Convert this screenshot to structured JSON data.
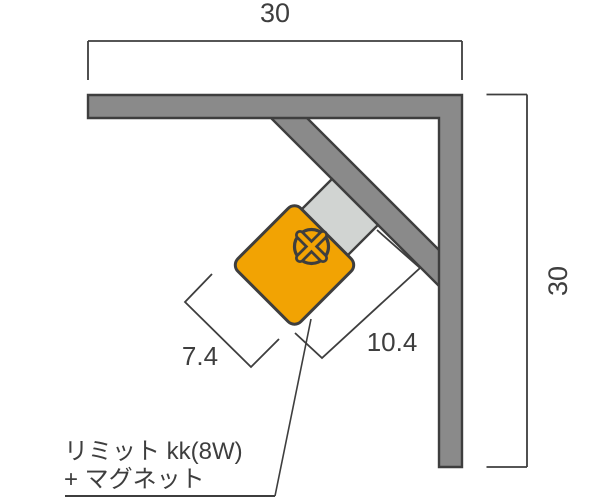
{
  "dimensions": {
    "top_width": "30",
    "right_height": "30",
    "switch_width": "7.4",
    "switch_length": "10.4"
  },
  "label": {
    "line1": "リミット kk(8W)",
    "line2": "+ マグネット"
  },
  "icons": {
    "screw_head": "circle-x-icon"
  },
  "colors": {
    "rail_fill": "#8a8a8a",
    "magnet_fill": "#d1d4d2",
    "switch_fill": "#f2a303",
    "outline": "#3e3e3e",
    "line_and_text": "#3e3e3e",
    "background": "#ffffff"
  }
}
